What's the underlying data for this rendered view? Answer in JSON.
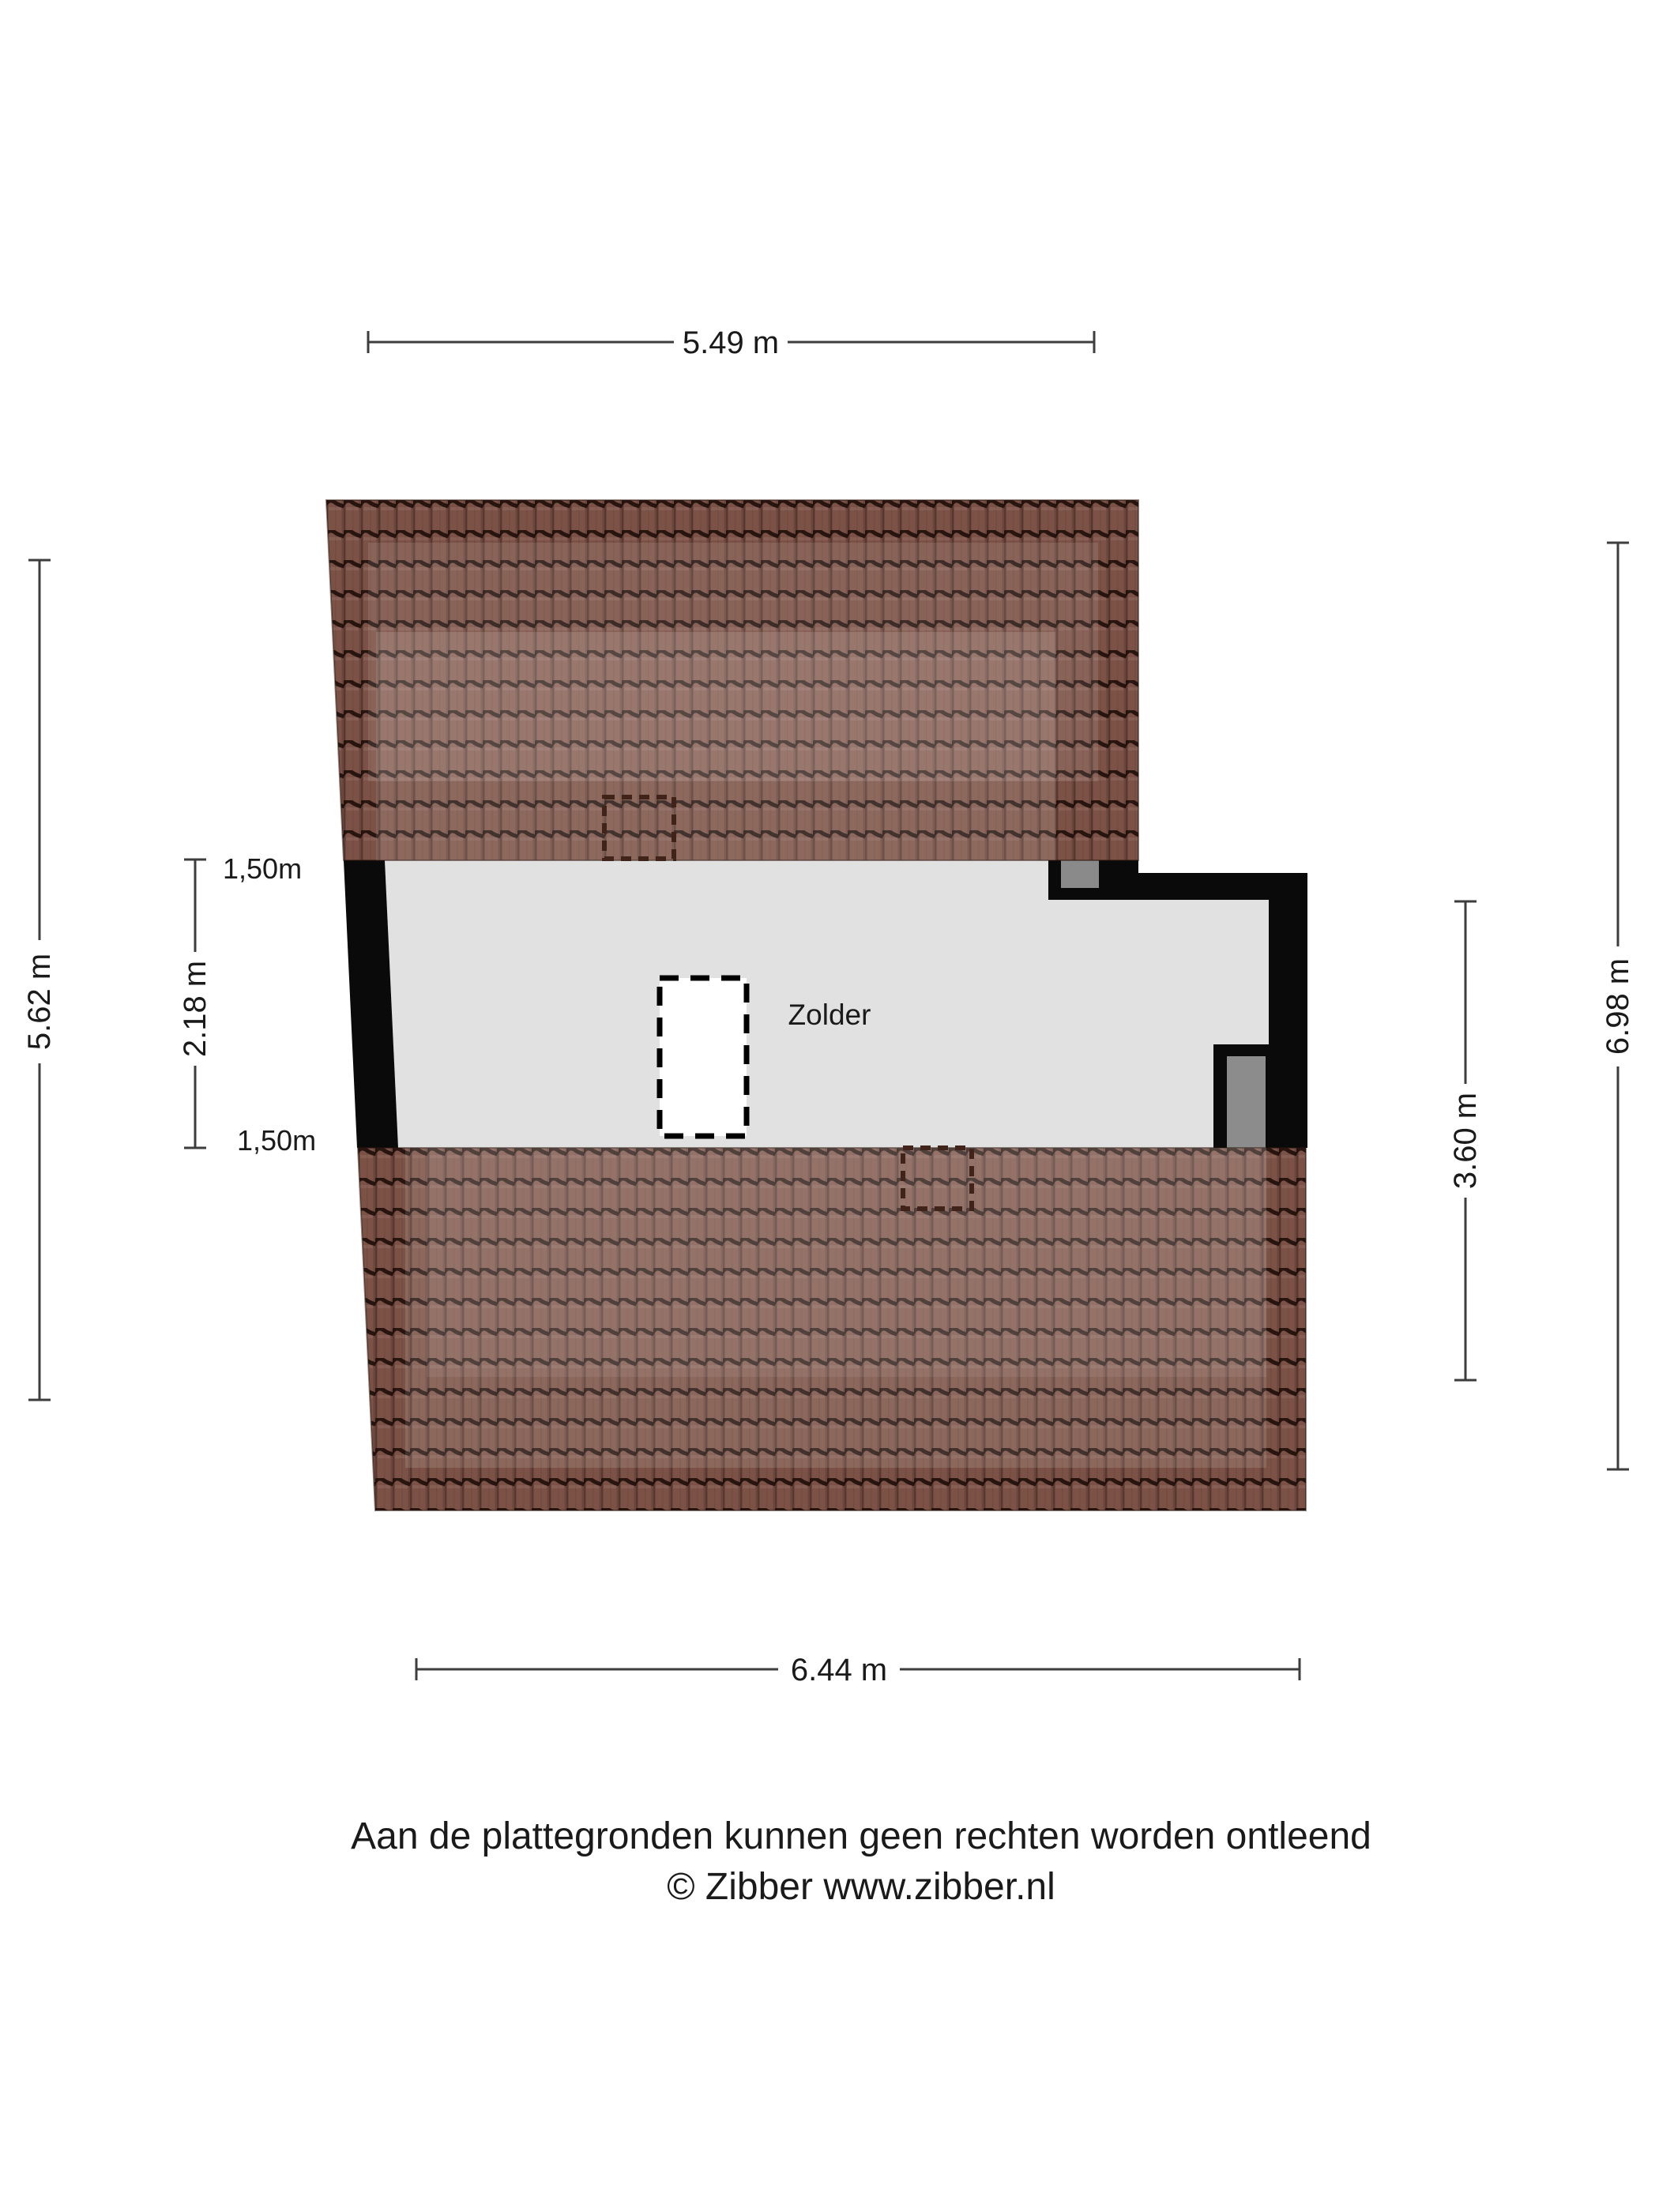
{
  "plan": {
    "room_label": "Zolder",
    "dimensions": {
      "top": "5.49 m",
      "bottom": "6.44 m",
      "left_outer": "5.62 m",
      "left_inner": "2.18 m",
      "right_outer": "6.98 m",
      "right_inner": "3.60 m",
      "headroom_top": "1,50m",
      "headroom_bottom": "1,50m"
    },
    "disclaimer": {
      "line1": "Aan de plattegronden kunnen geen rechten worden ontleend",
      "line2": "© Zibber www.zibber.nl"
    },
    "colors": {
      "roof_base": "#7d5246",
      "roof_seam": "#1a0b06",
      "floor": "#e1e1e1",
      "wall": "#0a0a0a",
      "door": "#8c8c8c",
      "chimney": "#8a8a8a",
      "dim_line": "#3d3d3d"
    }
  }
}
